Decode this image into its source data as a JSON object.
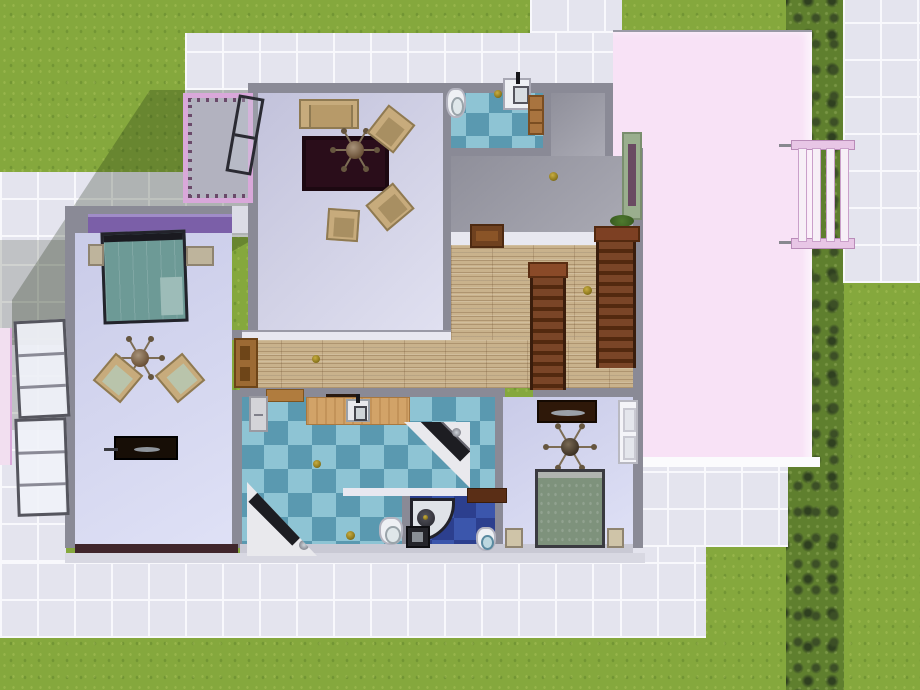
{
  "scene": {
    "title": "The Sims 3 — house floor plan, top-down view",
    "view": "top-down floorplan with surrounding yard"
  },
  "palette": {
    "grass": "#85a83d",
    "hedge": "#5f7f2e",
    "tile": "#e4e4ee",
    "tileLine": "#f8f8fc",
    "wall": "#8a8a96",
    "wallLight": "#e8e8f0",
    "wallDarkMaroon": "#40262b",
    "roofPink": "#f8e2f6",
    "roofEdgeWhite": "#fbfbfd",
    "fencePink": "#d9a8da",
    "balconyFloor": "#b2b2bf",
    "accentPurple": "#7b5fa8",
    "accentPurpleLight": "#a08cc8",
    "blueTileLight": "#8ec4d4",
    "blueTileDark": "#5a99b0",
    "navyTileLight": "#3b56ac",
    "navyTileDark": "#2c3f8e",
    "woodFloor": "#c9b28c",
    "stairWood": "#7a4527",
    "doorWood": "#9c6a34",
    "greenDoorFrame": "#9aae8e",
    "sofaTan": "#c7ab7c",
    "rugMaroon": "#2a0d1a",
    "bedTeal": "#6d9a96",
    "bedOlive": "#7e927c",
    "counterTan": "#d2a368",
    "applianceDark": "#1e1e24",
    "goldFixture": "#8f7a1d"
  },
  "rooms": {
    "livingRoom": "Living room",
    "balcony": "Fenced balcony",
    "bathroomTop": "Small bathroom",
    "greyRoom": "Landing room",
    "hallway": "Hallway with stairs",
    "bedroomLeft": "Master bedroom",
    "kitchenBath": "Kitchen / main bathroom",
    "showerRoom": "Navy shower room",
    "bedroomRight": "Second bedroom",
    "roof": "Pink flat roof section",
    "yard": "Lawn and tiled patio"
  },
  "furnitureLabels": {
    "sofa": "Loveseat sofa",
    "armchair": "Wooden armchair",
    "rug": "Dark maroon area rug",
    "ceilingFan": "Ceiling fan",
    "toilet": "Toilet",
    "sink": "Sink",
    "counter": "Kitchen counter with sink",
    "fridge": "Refrigerator",
    "tub": "Corner bathtub",
    "shower": "Corner shower stall",
    "bedTeal": "Double bed (teal bedding)",
    "bedOlive": "Double bed (olive bedding)",
    "nightstand": "Nightstand",
    "loungeChair": "Lounge chair",
    "desk": "Dark writing desk",
    "dresser": "Wooden dresser",
    "consoleTable": "Console table",
    "stairs": "Wooden staircase",
    "doorWood": "Open wooden door",
    "doorGreen": "Green exterior door",
    "doorWhite": "Open white door",
    "window": "Open casement window",
    "trellis": "Pink garden trellis",
    "lamp": "Gold fixture",
    "shelf": "Wall shelf"
  }
}
